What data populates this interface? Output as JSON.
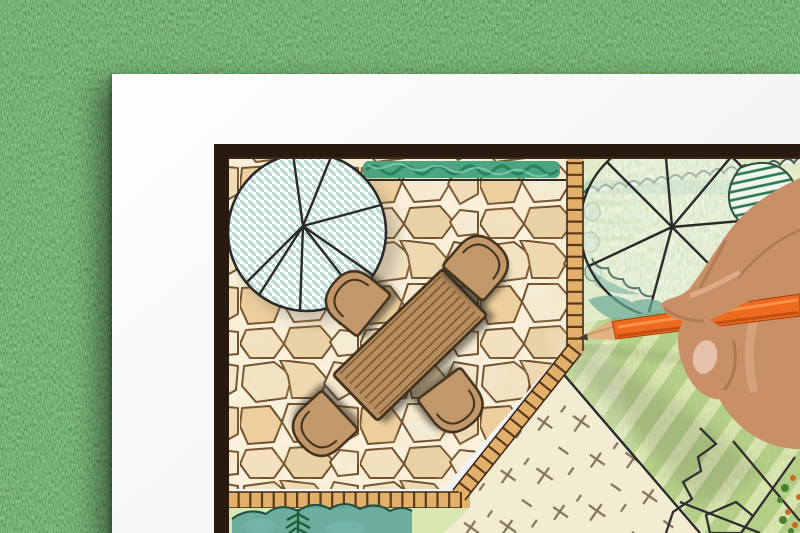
{
  "colors": {
    "grass_base": "#4e7b3d",
    "grass_dark": "#2f5a2c",
    "grass_light": "#8fbb72",
    "paper": "#f4f5f7",
    "frame": "#291a10",
    "mortar": "#faf2df",
    "stone_stroke": "#6f4e2b",
    "stone_fill": "#f0e0bf",
    "hedge_green": "#4ba583",
    "hedge_dark": "#1e7a57",
    "tree_hatch": "#b7d7d0",
    "ink": "#2a2a2a",
    "table_wood": "#b88d5e",
    "table_line": "#74552f",
    "chair_fill": "#c2986a",
    "chair_stroke": "#41301c",
    "brick_fill": "#e2b06a",
    "brick_rung": "#5a3a1c",
    "garden_bg": "#e9efcf",
    "lawn_light": "#dfe8b4",
    "lawn_green": "#b7d188",
    "cream": "#f3ecd3",
    "cream_mark": "#84745c",
    "shrub_teal": "#6aaa97",
    "shrub_dark": "#2a7a50",
    "bed_green": "#63a89b",
    "fern_green": "#1d5c33",
    "pencil_orange": "#ed6a1f",
    "pencil_light": "#ff9850",
    "pencil_dark": "#bf4e10",
    "pencil_wood": "#e2b382",
    "graphite": "#4a3a30",
    "skin": "#c98f66",
    "skin_dark": "#8e5c3c",
    "skin_light": "#eec3a0",
    "nail": "#e8c6b2",
    "rock_line": "#2f2f2f",
    "fleck_orange": "#cc6a24",
    "fleck_green": "#47802f"
  }
}
